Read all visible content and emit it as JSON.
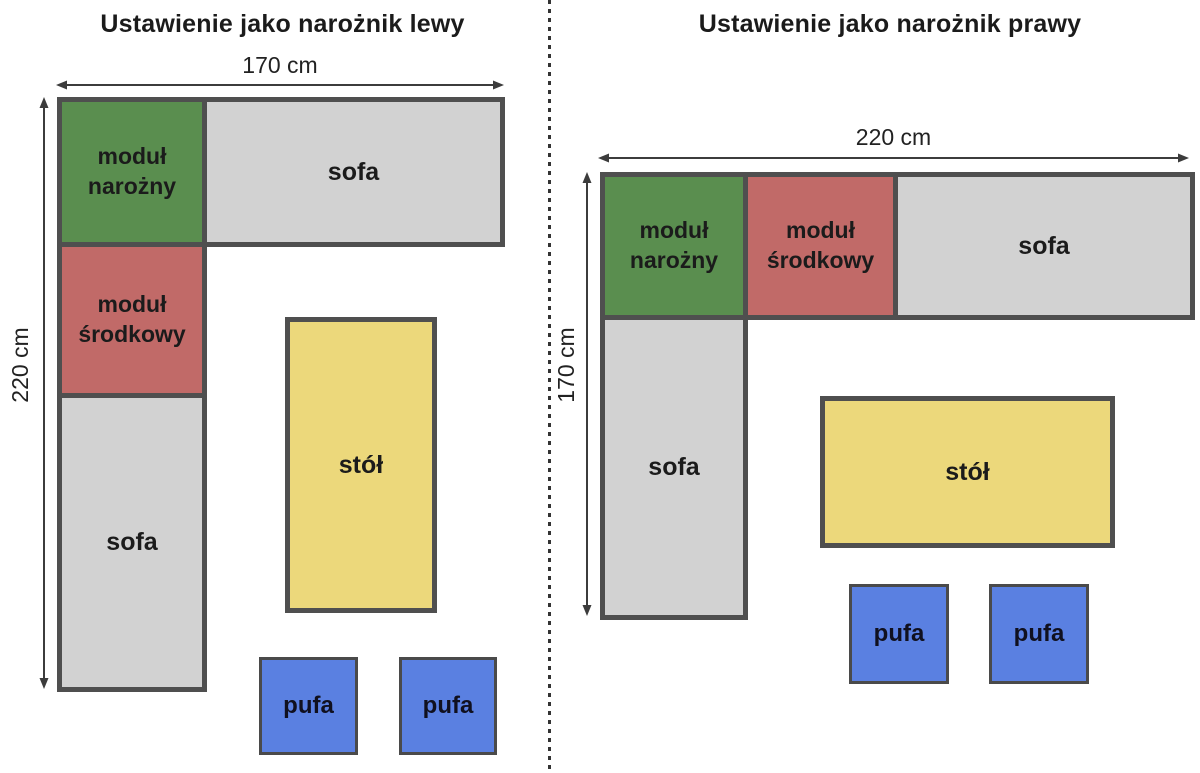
{
  "colors": {
    "corner_module": "#5a8e4f",
    "middle_module": "#c16a68",
    "sofa": "#d2d2d2",
    "table": "#ecd87b",
    "pufa": "#5a80e1",
    "outline": "#4f4f4f"
  },
  "left_diagram": {
    "title": "Ustawienie jako narożnik lewy",
    "width_label": "170 cm",
    "height_label": "220 cm",
    "corner_module_label": "moduł\nnarożny",
    "middle_module_label": "moduł\nśrodkowy",
    "sofa_top_label": "sofa",
    "sofa_side_label": "sofa",
    "table_label": "stół",
    "pufa_left_label": "pufa",
    "pufa_right_label": "pufa"
  },
  "right_diagram": {
    "title": "Ustawienie jako narożnik prawy",
    "width_label": "220 cm",
    "height_label": "170 cm",
    "corner_module_label": "moduł\nnarożny",
    "middle_module_label": "moduł\nśrodkowy",
    "sofa_top_label": "sofa",
    "sofa_side_label": "sofa",
    "table_label": "stół",
    "pufa_left_label": "pufa",
    "pufa_right_label": "pufa"
  }
}
